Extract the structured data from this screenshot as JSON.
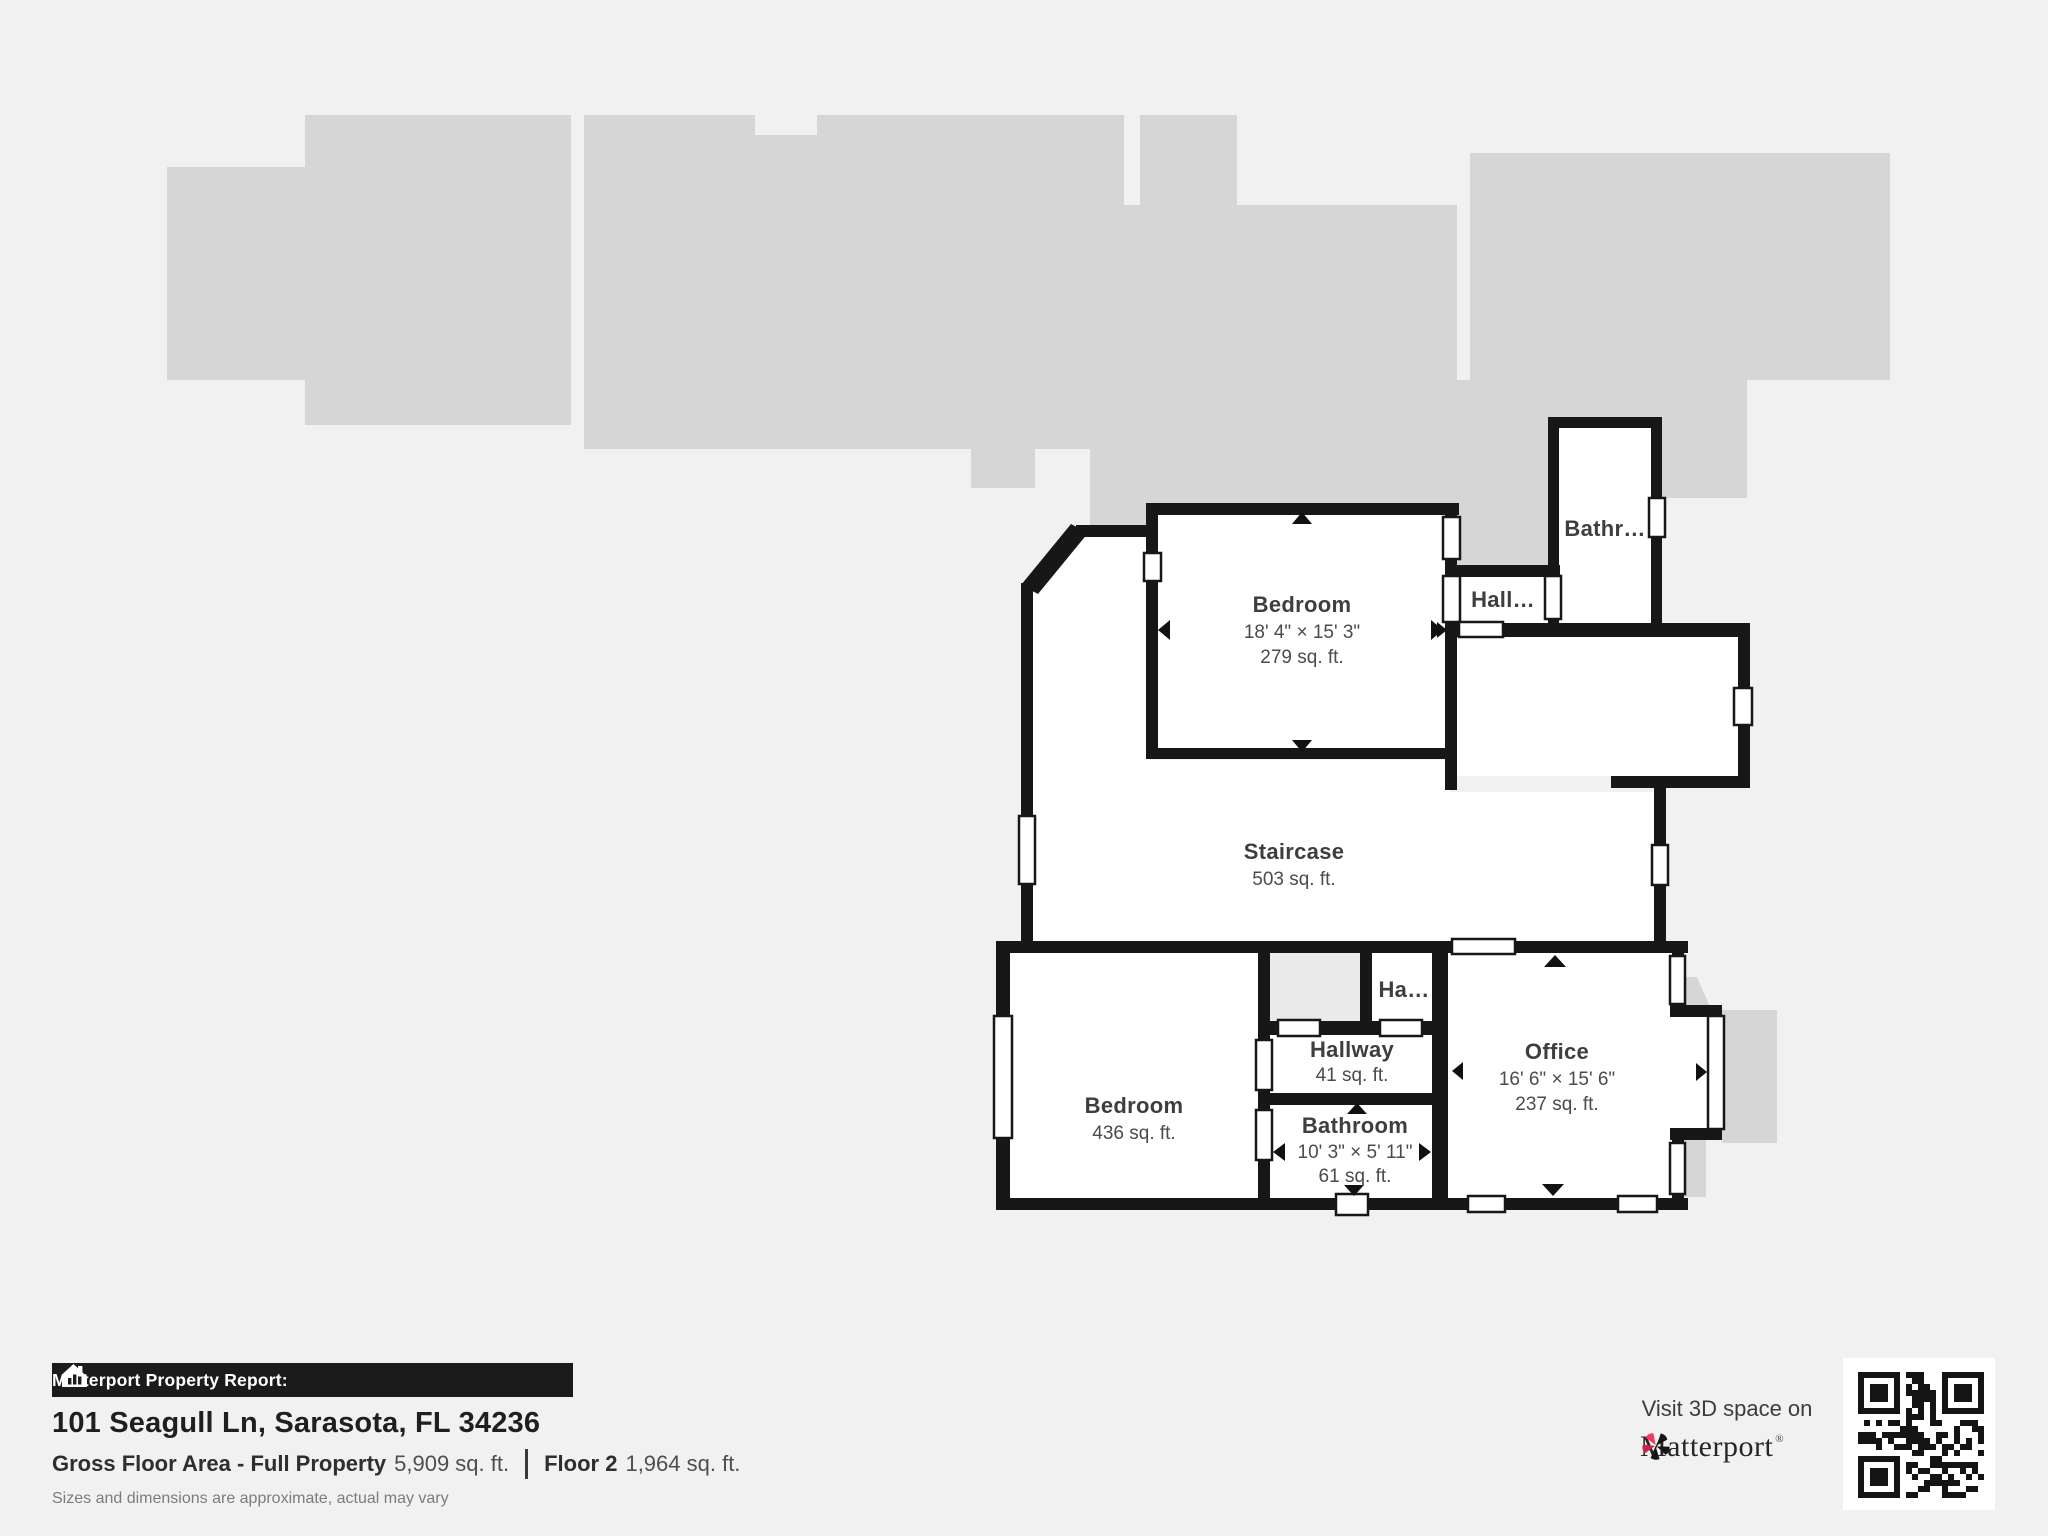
{
  "rooms": {
    "bedroom_upper": {
      "name": "Bedroom",
      "dimensions": "18' 4\" × 15' 3\"",
      "area": "279 sq. ft."
    },
    "staircase": {
      "name": "Staircase",
      "area": "503 sq. ft."
    },
    "hall_upper": {
      "name": "Hall…"
    },
    "bathroom_upper": {
      "name": "Bathr…"
    },
    "bedroom_lower": {
      "name": "Bedroom",
      "area": "436 sq. ft."
    },
    "hallway": {
      "name": "Hallway",
      "area": "41 sq. ft."
    },
    "hall_small": {
      "name": "Ha…"
    },
    "bathroom_lower": {
      "name": "Bathroom",
      "dimensions": "10' 3\" × 5' 11\"",
      "area": "61 sq. ft."
    },
    "office": {
      "name": "Office",
      "dimensions": "16' 6\" × 15' 6\"",
      "area": "237 sq. ft."
    }
  },
  "footer": {
    "report_label": "Matterport Property Report:",
    "address": "101 Seagull Ln, Sarasota, FL 34236",
    "gross_label": "Gross Floor Area - Full Property",
    "gross_value": "5,909 sq. ft.",
    "floor_label": "Floor 2",
    "floor_value": "1,964 sq. ft.",
    "disclaimer": "Sizes and dimensions are approximate, actual may vary"
  },
  "branding": {
    "visit_text": "Visit 3D space on",
    "brand": "Matterport",
    "brand_mark": "®"
  },
  "colors": {
    "background": "#f1f1f1",
    "silhouette": "#d6d6d6",
    "silhouette_light": "#eaeaea",
    "wall": "#171717",
    "accent_red": "#f13a5e",
    "label_text": "#3e3e3e"
  }
}
